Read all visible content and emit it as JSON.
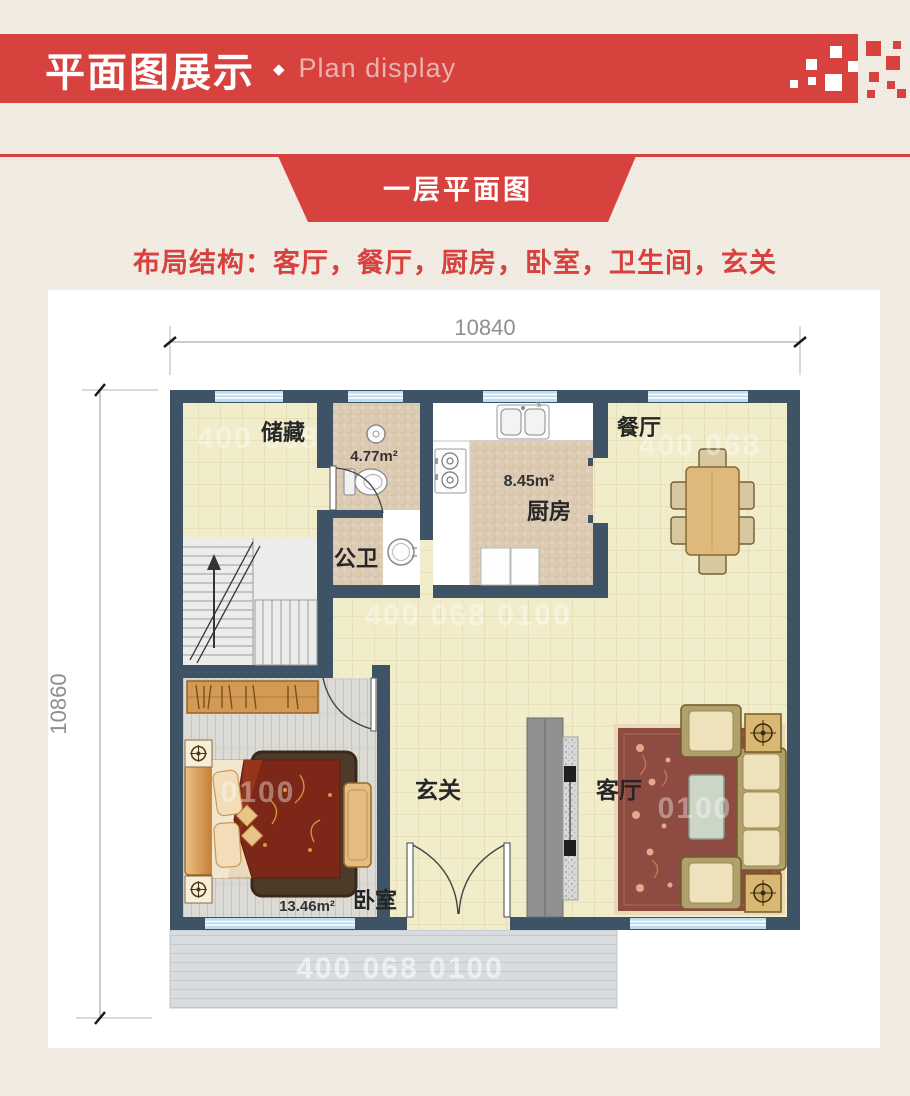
{
  "header": {
    "title": "平面图展示",
    "separator": "◆",
    "subtitle": "Plan display"
  },
  "section_ribbon": {
    "label": "一层平面图"
  },
  "layout_summary": {
    "text": "布局结构：客厅，餐厅，厨房，卧室，卫生间，玄关"
  },
  "floor_plan": {
    "dim_top": "10840",
    "dim_left": "10860",
    "rooms": {
      "storage": {
        "label": "储藏"
      },
      "bathroom": {
        "label": "公卫",
        "area": "4.77m²"
      },
      "kitchen": {
        "label": "厨房",
        "area": "8.45m²"
      },
      "dining": {
        "label": "餐厅"
      },
      "entry": {
        "label": "玄关"
      },
      "living": {
        "label": "客厅"
      },
      "bedroom": {
        "label": "卧室",
        "area": "13.46m²"
      }
    }
  },
  "watermark": {
    "digits": "400 068 0100",
    "digits_a": "400 068",
    "digits_b": "0100"
  },
  "colors": {
    "accent_red": "#d7423e",
    "wall": "#3e5365",
    "window_blue": "#bdddef",
    "floor_cream": "#f1ecca",
    "subtitle_pink": "#ecb3ad"
  }
}
